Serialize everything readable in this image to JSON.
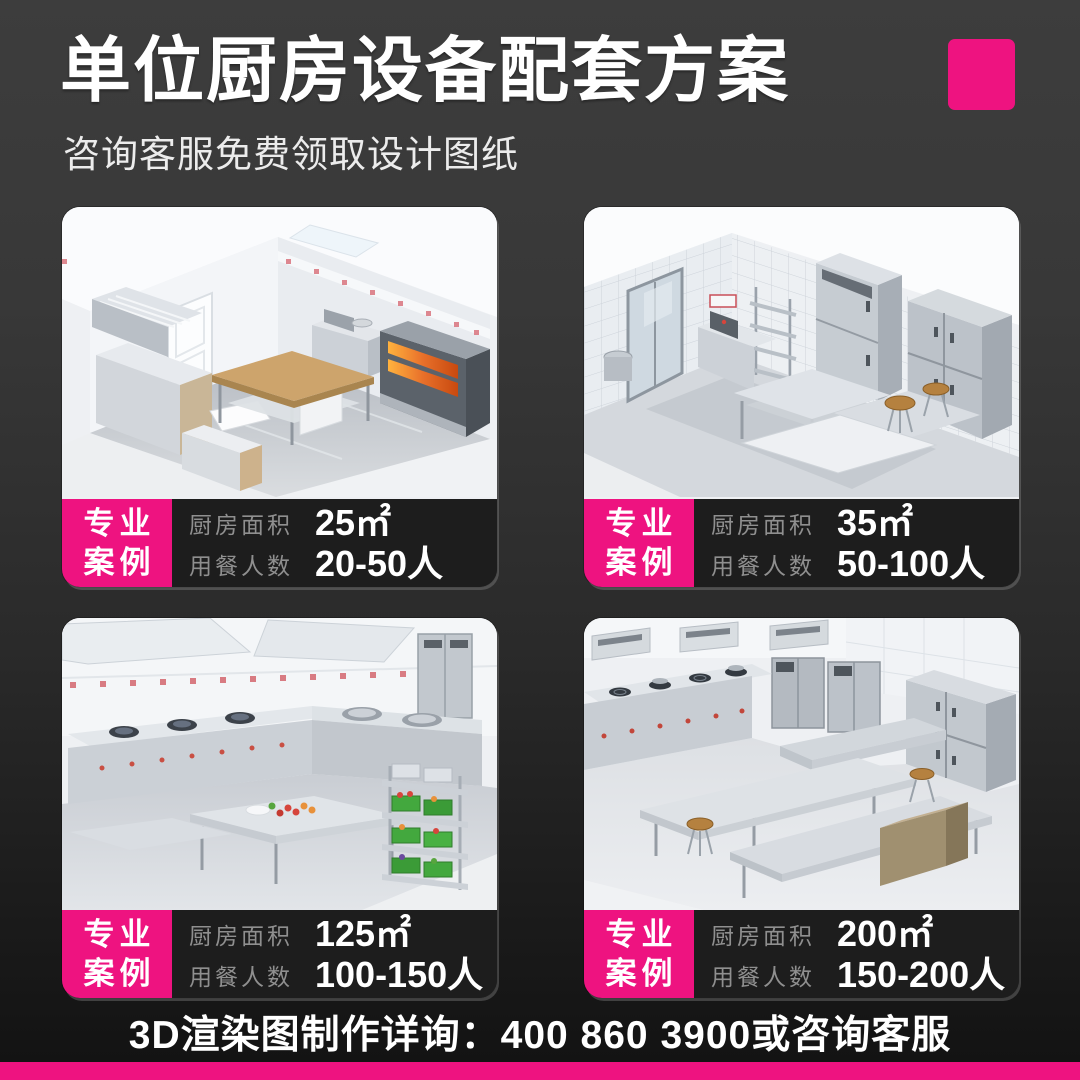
{
  "page": {
    "title": "单位厨房设备配套方案",
    "subtitle": "咨询客服免费领取设计图纸",
    "footer": "3D渲染图制作详询：400 860 3900或咨询客服",
    "accent_color": "#EE1380",
    "background_top": "#3D3D3D",
    "background_bottom": "#121212",
    "info_bar_color": "#1D1D1D",
    "label_color": "#8F8F8F"
  },
  "cards": [
    {
      "badge_line1": "专业",
      "badge_line2": "案例",
      "area_label": "厨房面积",
      "area_value": "25㎡",
      "diners_label": "用餐人数",
      "diners_value": "20-50人"
    },
    {
      "badge_line1": "专业",
      "badge_line2": "案例",
      "area_label": "厨房面积",
      "area_value": "35㎡",
      "diners_label": "用餐人数",
      "diners_value": "50-100人"
    },
    {
      "badge_line1": "专业",
      "badge_line2": "案例",
      "area_label": "厨房面积",
      "area_value": "125㎡",
      "diners_label": "用餐人数",
      "diners_value": "100-150人"
    },
    {
      "badge_line1": "专业",
      "badge_line2": "案例",
      "area_label": "厨房面积",
      "area_value": "200㎡",
      "diners_label": "用餐人数",
      "diners_value": "150-200人"
    }
  ]
}
